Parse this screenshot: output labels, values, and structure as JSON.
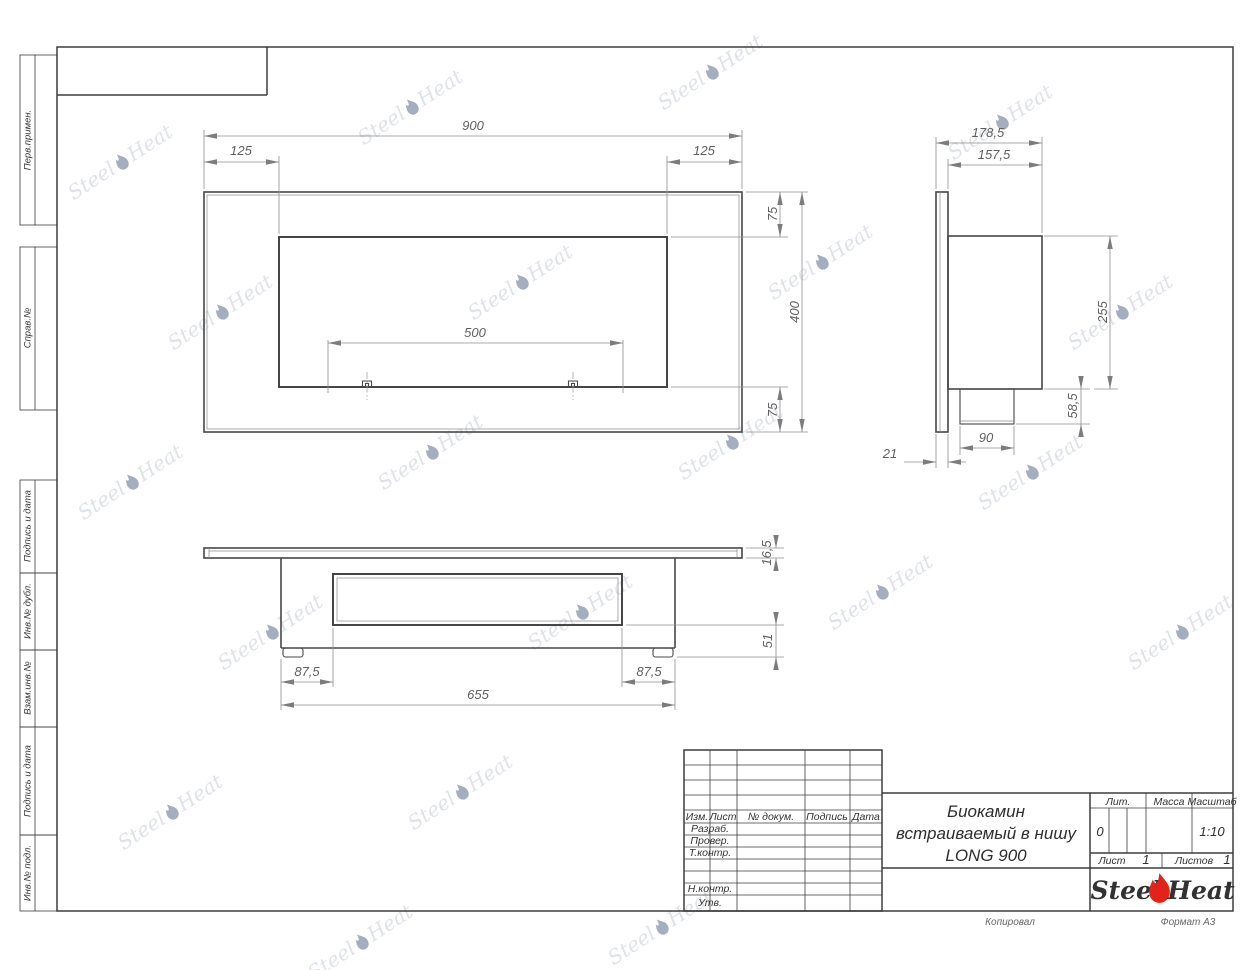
{
  "sheet": {
    "copied": "Копировал",
    "format": "Формат А3"
  },
  "sidebar": {
    "items": [
      {
        "label": "Перв.примен."
      },
      {
        "label": "Справ.№"
      },
      {
        "label": "Подпись и дата"
      },
      {
        "label": "Инв.№ дубл."
      },
      {
        "label": "Взам.инв.№"
      },
      {
        "label": "Подпись и дата"
      },
      {
        "label": "Инв.№ подл."
      }
    ]
  },
  "views": {
    "front": {
      "width": "900",
      "left_offset": "125",
      "right_offset": "125",
      "burner_span": "500",
      "top_margin": "75",
      "height": "400",
      "bottom_margin": "75"
    },
    "side": {
      "depth_total": "178,5",
      "depth_body": "157,5",
      "body_height": "255",
      "box_height": "58,5",
      "box_width": "90",
      "flange": "21"
    },
    "bottom": {
      "plate": "16,5",
      "foot": "51",
      "inset_left": "87,5",
      "inset_right": "87,5",
      "body_width": "655"
    }
  },
  "title_block": {
    "cols": {
      "izm": "Изм.",
      "list": "Лист",
      "doc": "№ докум.",
      "sign": "Подпись",
      "date": "Дата"
    },
    "rows": {
      "razrab": "Разраб.",
      "prover": "Провер.",
      "tkontr": "Т.контр.",
      "nkontr": "Н.контр.",
      "utv": "Утв."
    },
    "title1": "Биокамин",
    "title2": "встраиваемый в нишу",
    "title3": "LONG 900",
    "lit": "Лит.",
    "lit_value": "0",
    "mass": "Масса",
    "scale": "Масштаб",
    "scale_value": "1:10",
    "sheet": "Лист",
    "sheet_no": "1",
    "sheets": "Листов",
    "sheets_no": "1"
  },
  "logo": {
    "steel": "Steel",
    "heat": "Heat"
  },
  "colors": {
    "line": "#474747",
    "dim": "#8f8f8f",
    "red": "#e2231a",
    "watermark": "#96a0b4"
  }
}
